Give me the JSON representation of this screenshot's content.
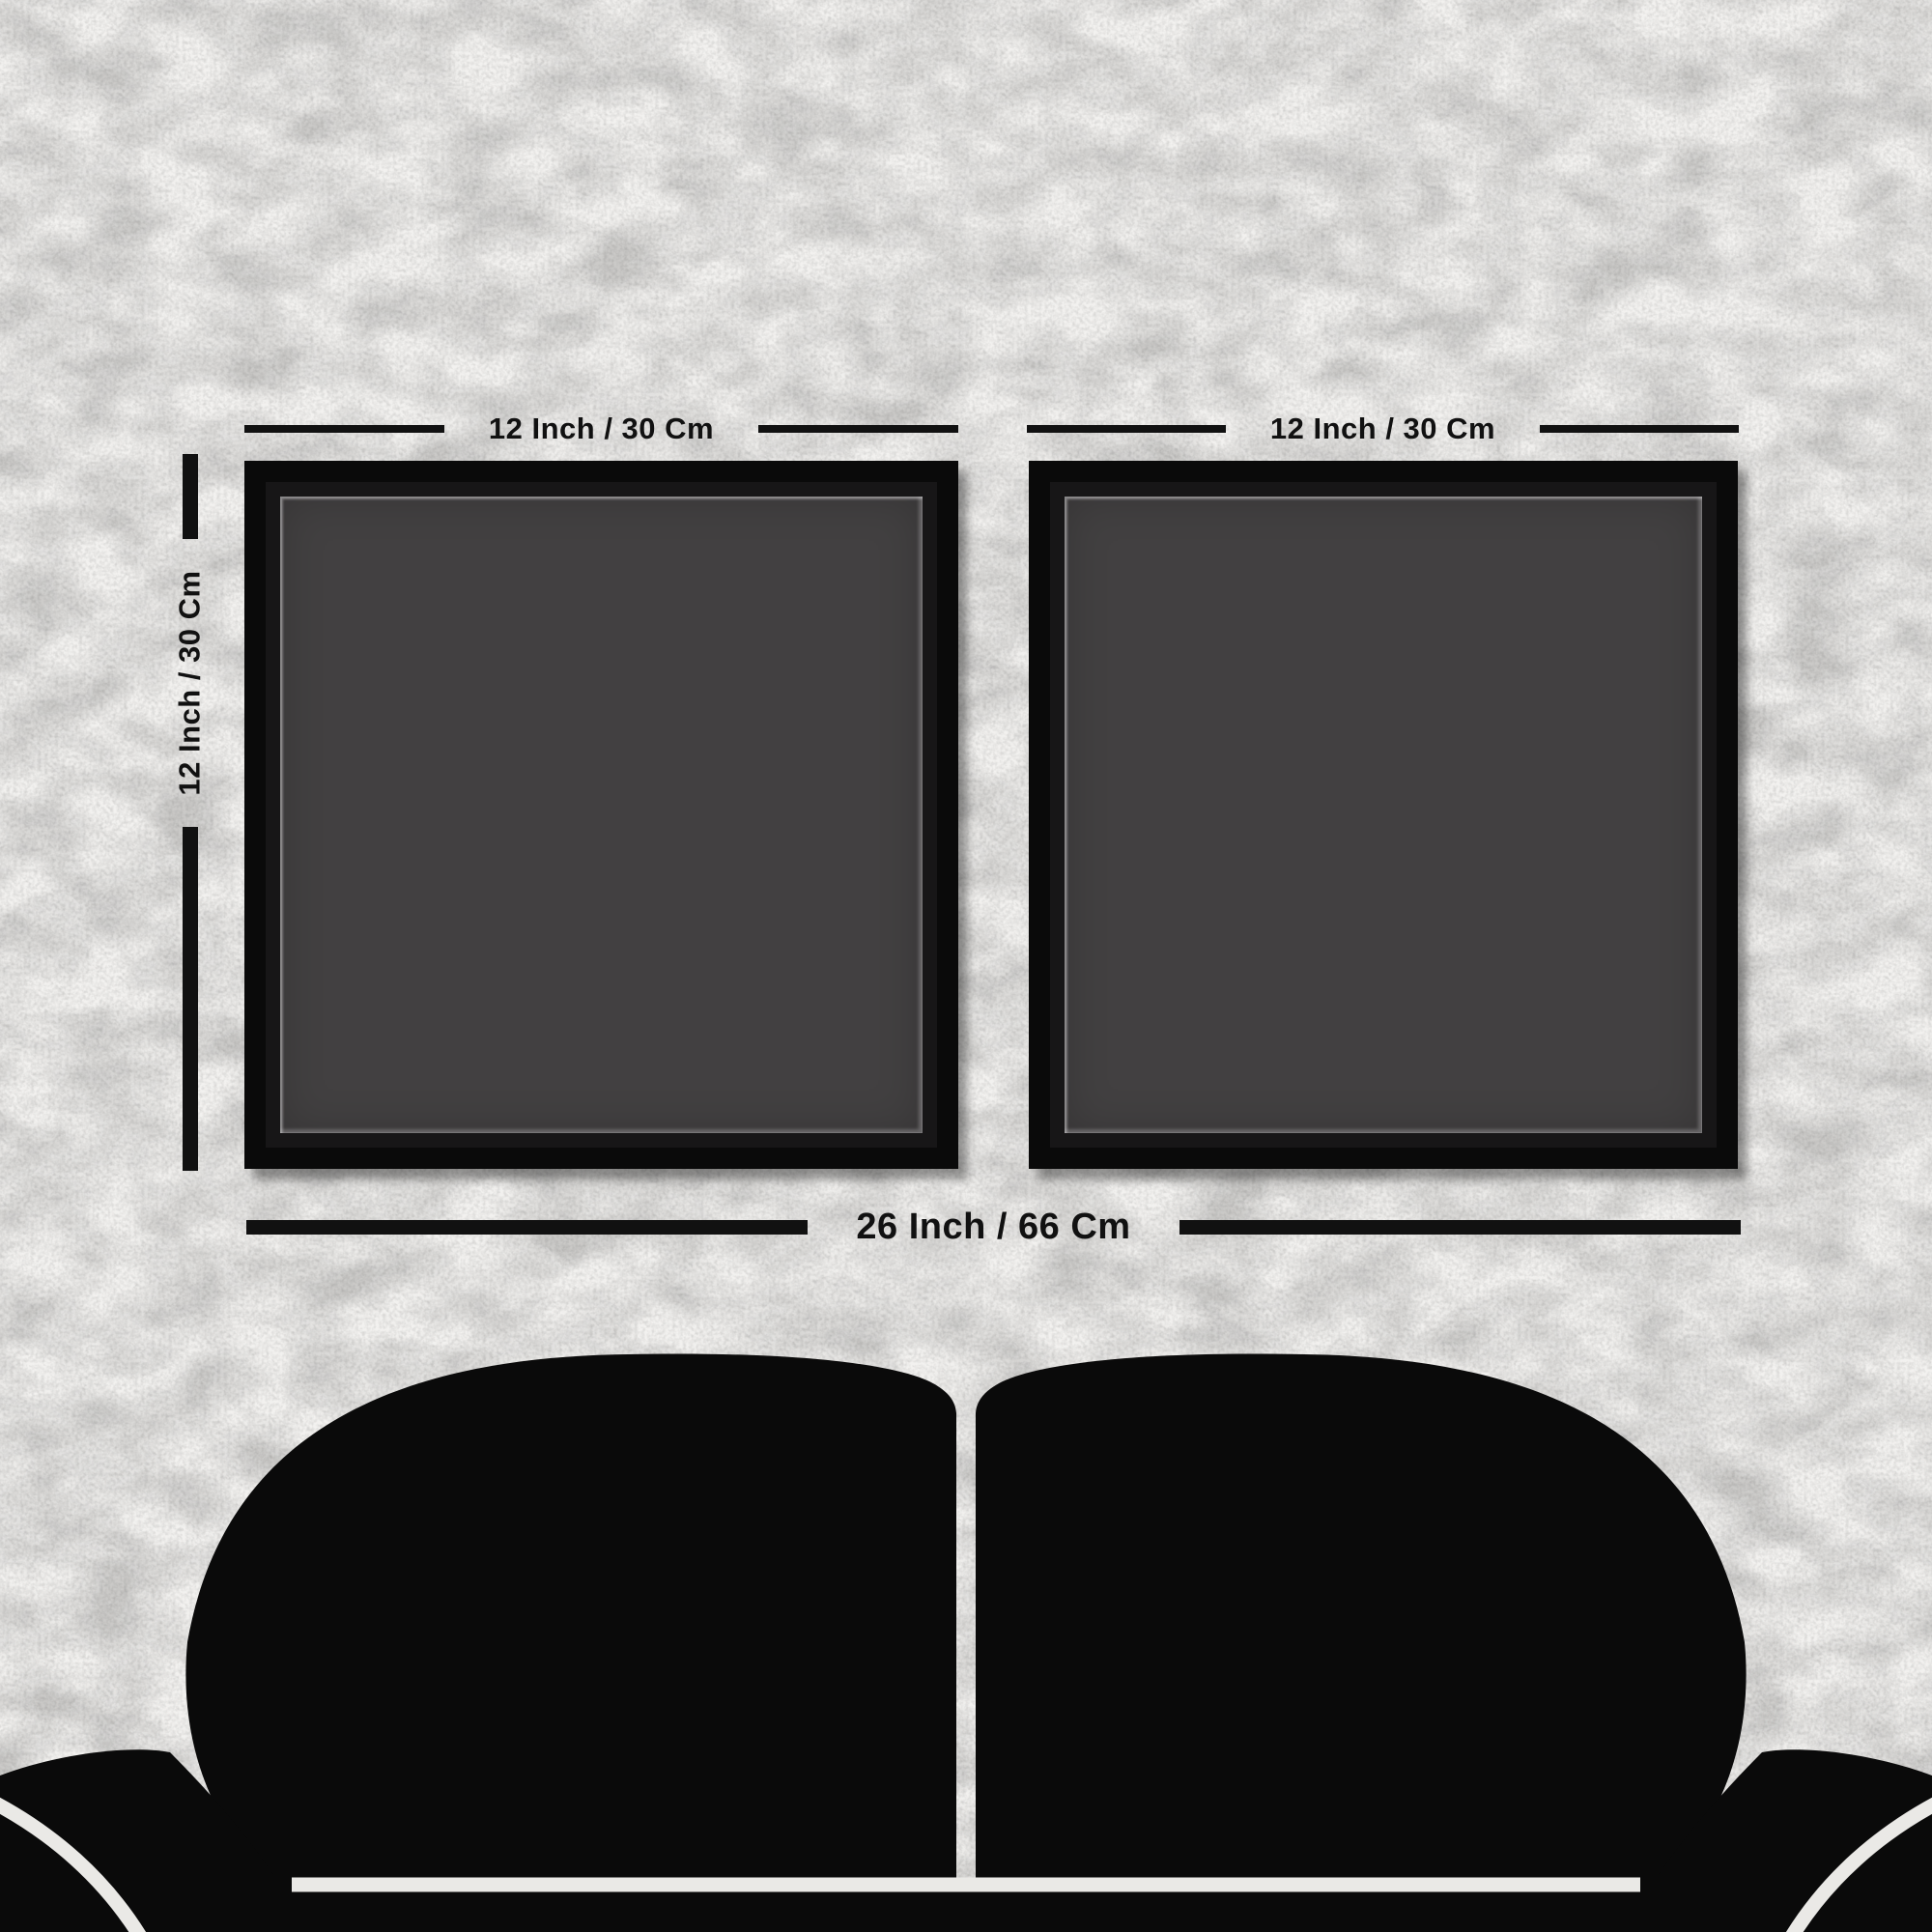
{
  "product_diagram": {
    "wall": {
      "background_color": "#f2f1ef",
      "texture": "white-leather-grain"
    },
    "frames": [
      {
        "id": "left",
        "width_label": "12 Inch / 30 Cm"
      },
      {
        "id": "right",
        "width_label": "12 Inch / 30 Cm"
      }
    ],
    "height_label": "12 Inch / 30 Cm",
    "total_width_label": "26 Inch / 66 Cm",
    "colors": {
      "frame": "#0a0a0a",
      "canvas": "#424041",
      "dimension_marks": "#111111",
      "couch": "#0a0a0a",
      "couch_seams": "#eae9e6"
    }
  }
}
